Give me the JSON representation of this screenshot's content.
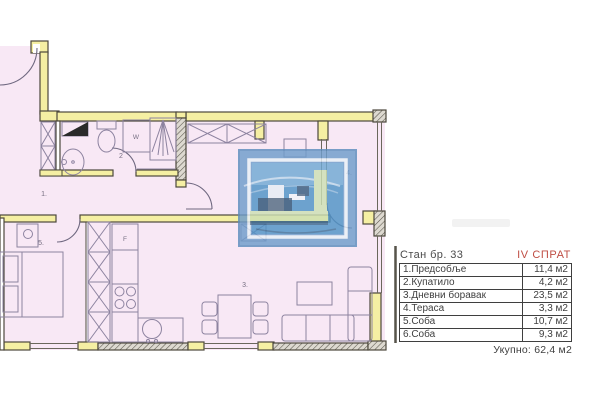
{
  "header": {
    "apartment_title": "Стан бр. 33",
    "floor_label": "IV СПРАТ"
  },
  "area_table": {
    "rows": [
      {
        "name": "1.Предсобље",
        "area": "11,4 м2"
      },
      {
        "name": "2.Купатило",
        "area": "4,2 м2"
      },
      {
        "name": "3.Дневни боравак",
        "area": "23,5 м2"
      },
      {
        "name": "4.Тераса",
        "area": "3,3 м2"
      },
      {
        "name": "5.Соба",
        "area": "10,7 м2"
      },
      {
        "name": "6.Соба",
        "area": "9,3 м2"
      }
    ],
    "total_label": "Укупно:",
    "total_value": "62,4 м2"
  },
  "plan": {
    "labels": [
      {
        "text": "1."
      },
      {
        "text": "2"
      },
      {
        "text": "3."
      },
      {
        "text": "4."
      },
      {
        "text": "5."
      },
      {
        "text": "W"
      },
      {
        "text": "F"
      }
    ],
    "colors": {
      "floor_fill": "#f8e8f5",
      "wall_yellow": "#f5efa3",
      "accent_red": "#bf4d43",
      "watermark_blue": "#4f93c6",
      "watermark_green": "#cde0b4"
    }
  }
}
